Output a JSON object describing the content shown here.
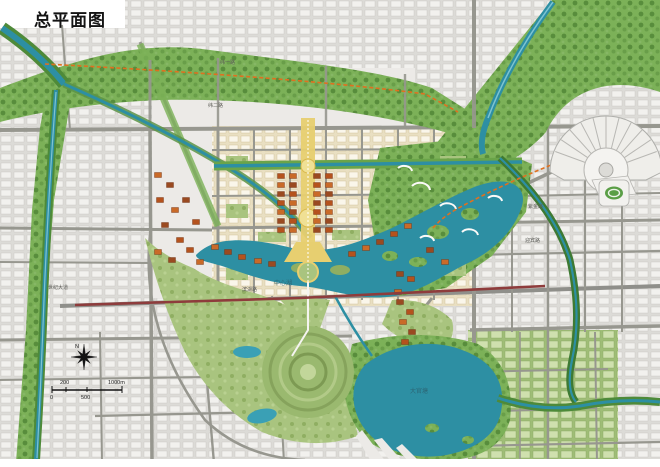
{
  "title": "总平面图",
  "map": {
    "lakes": {
      "center": "中心湖",
      "south": "大官塘"
    },
    "roads": {
      "wei1": "纬一路",
      "wei2": "纬二路",
      "zijin": "紫金路",
      "yingbin": "迎宾路",
      "shiji": "世纪大道",
      "binhu": "滨湖路"
    },
    "scalebar": {
      "zero": "0",
      "two_hundred": "200",
      "five_hundred": "500",
      "one_thousand": "1000m"
    },
    "compass_n": "N",
    "colors": {
      "water": "#2d8fa3",
      "water_light": "#5ab4c6",
      "greenway": "#7cb158",
      "park": "#a9c47f",
      "axis_yellow": "#e7cf70",
      "building_orange": "#b5521d",
      "transit_dash": "#e0701f",
      "arterial_red": "#8e3c3c",
      "fabric_gray": "#e6e5e2",
      "cream_block": "#e9dfc2"
    }
  }
}
